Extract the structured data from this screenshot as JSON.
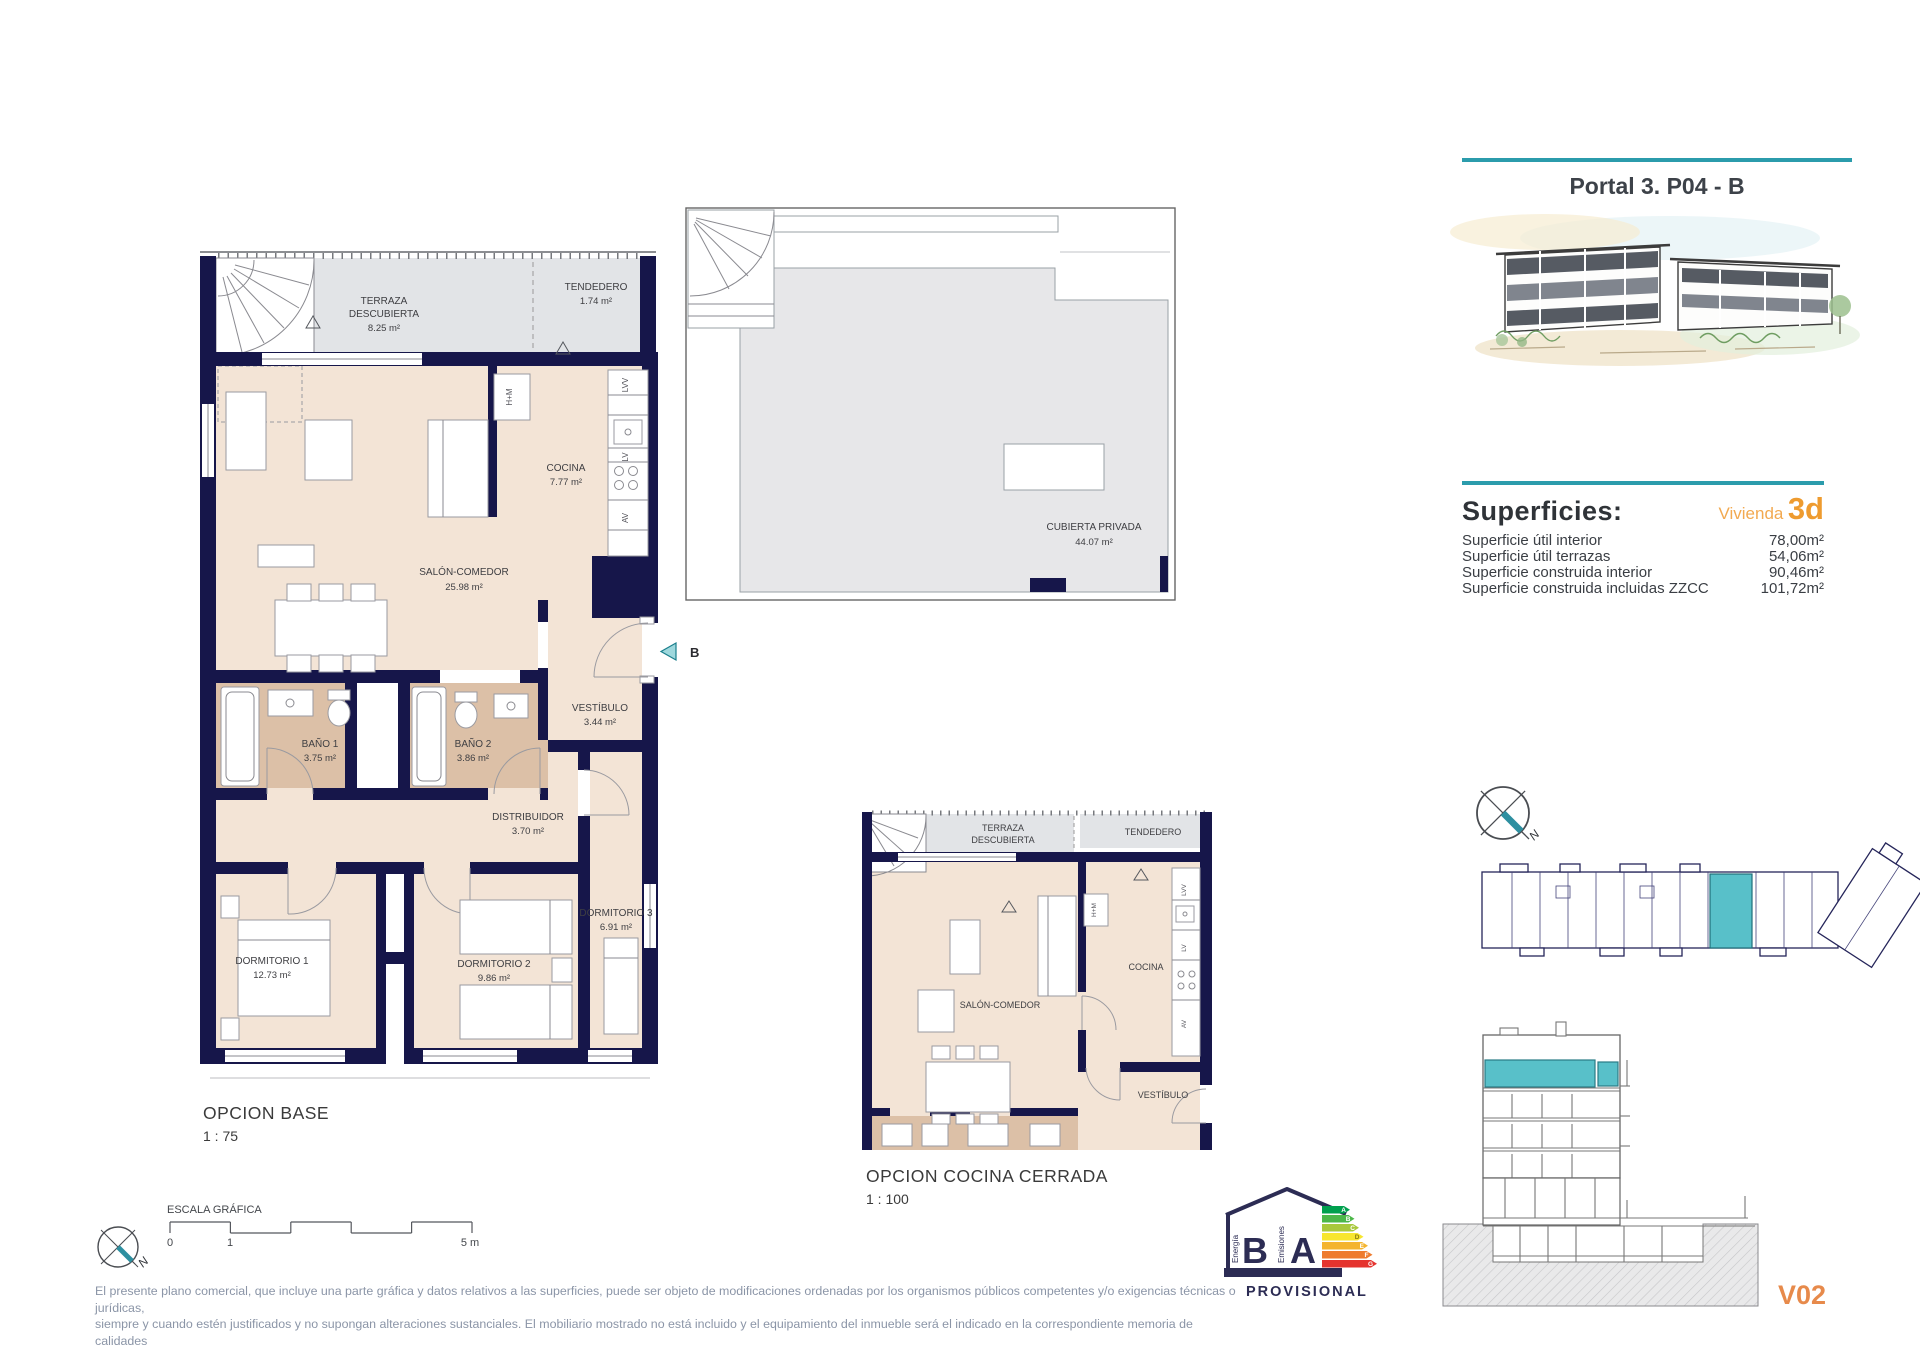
{
  "colors": {
    "accent_teal": "#2b9cac",
    "unit_highlight": "#58c0c9",
    "entry_teal": "#9ed8dd",
    "wall_navy": "#16164a",
    "floor_beige": "#f3e4d6",
    "bath_tan": "#dcc0a7",
    "terrace_gray": "#e2e4e7",
    "vivienda_orange": "#ee9b2f",
    "version_orange": "#e78a4b",
    "disclaimer_gray": "#8b95a7"
  },
  "header": {
    "title": "Portal 3. P04 - B"
  },
  "superficies": {
    "heading": "Superficies:",
    "vivienda_label": "Vivienda",
    "vivienda_value": "3d",
    "rows": [
      {
        "label": "Superficie útil interior",
        "value": "78,00m²"
      },
      {
        "label": "Superficie útil terrazas",
        "value": "54,06m²"
      },
      {
        "label": "Superficie construida interior",
        "value": "90,46m²"
      },
      {
        "label": "Superficie construida incluidas ZZCC",
        "value": "101,72m²"
      }
    ]
  },
  "main_plan": {
    "caption": "OPCION BASE",
    "scale": "1 : 75",
    "entry_label": "B",
    "rooms": {
      "terraza_line1": "TERRAZA",
      "terraza_line2": "DESCUBIERTA",
      "terraza_area": "8.25 m²",
      "tendedero": "TENDEDERO",
      "tendedero_area": "1.74 m²",
      "cocina": "COCINA",
      "cocina_area": "7.77 m²",
      "salon": "SALÓN-COMEDOR",
      "salon_area": "25.98 m²",
      "bano1": "BAÑO 1",
      "bano1_area": "3.75 m²",
      "bano2": "BAÑO 2",
      "bano2_area": "3.86 m²",
      "vestibulo": "VESTÍBULO",
      "vestibulo_area": "3.44 m²",
      "distribuidor": "DISTRIBUIDOR",
      "distribuidor_area": "3.70 m²",
      "dormitorio1": "DORMITORIO 1",
      "dormitorio1_area": "12.73 m²",
      "dormitorio2": "DORMITORIO 2",
      "dormitorio2_area": "9.86 m²",
      "dormitorio3": "DORMITORIO 3",
      "dormitorio3_area": "6.91 m²"
    },
    "appliances": {
      "lvv": "LVV",
      "lv": "LV",
      "av": "AV",
      "hm": "H+M"
    }
  },
  "roof_plan": {
    "label": "CUBIERTA PRIVADA",
    "area": "44.07 m²"
  },
  "small_plan": {
    "caption": "OPCION COCINA CERRADA",
    "scale": "1 : 100",
    "rooms": {
      "terraza_line1": "TERRAZA",
      "terraza_line2": "DESCUBIERTA",
      "tendedero": "TENDEDERO",
      "salon": "SALÓN-COMEDOR",
      "cocina": "COCINA",
      "vestibulo": "VESTÍBULO"
    },
    "hm": "H+M"
  },
  "scalebar": {
    "title": "ESCALA GRÁFICA",
    "tick0": "0",
    "tick1": "1",
    "tick5": "5 m"
  },
  "compass": {
    "north": "N"
  },
  "energy_label": {
    "letter_energy": "B",
    "letter_emissions": "A",
    "energia": "Energía",
    "emisiones": "Emisiones",
    "status": "PROVISIONAL",
    "grades": [
      "A",
      "B",
      "C",
      "D",
      "E",
      "F",
      "G"
    ]
  },
  "footer": {
    "disclaimer_line1": "El presente plano comercial, que incluye una parte gráfica y datos relativos a las superficies, puede ser objeto de modificaciones ordenadas por los organismos públicos competentes y/o exigencias técnicas o jurídicas,",
    "disclaimer_line2": "siempre y cuando estén justificados y no supongan alteraciones sustanciales. El mobiliario mostrado no está incluido y el equipamiento del inmueble será el indicado en la correspondiente memoria de calidades",
    "version": "V02"
  }
}
